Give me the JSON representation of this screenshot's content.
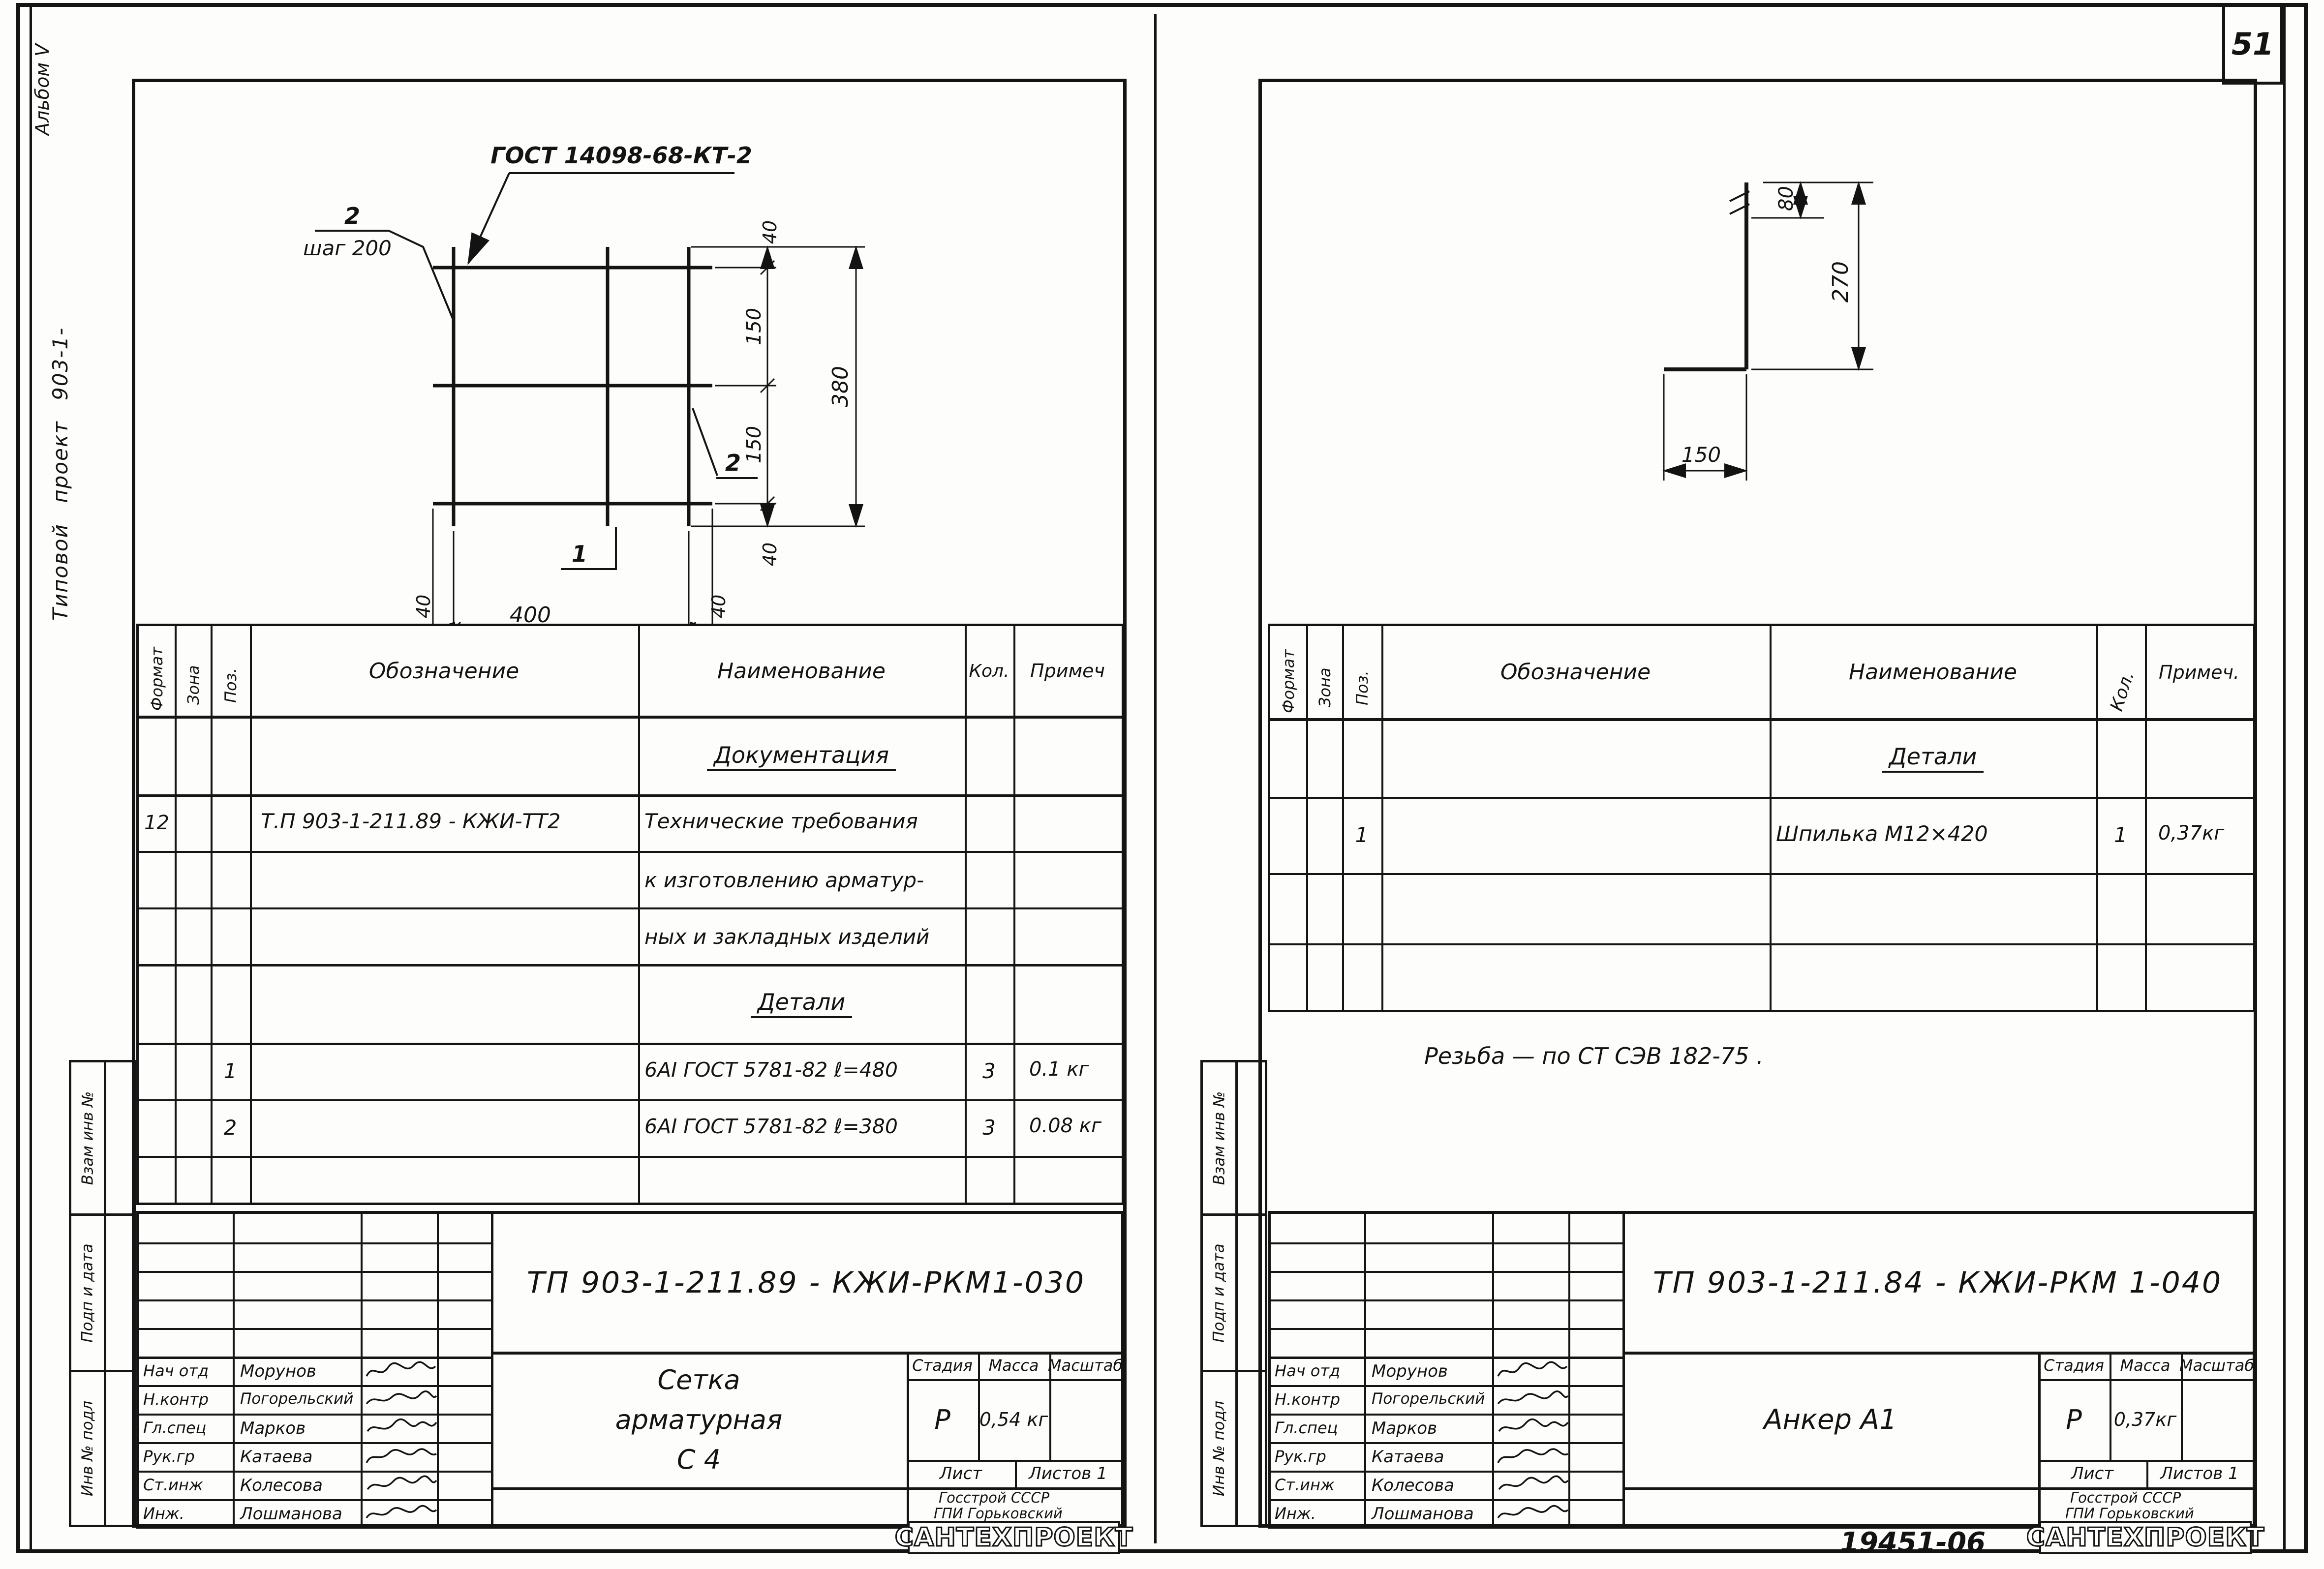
{
  "page": {
    "corner_number": "51",
    "footer_code": "19451-06",
    "footer_number": "52"
  },
  "margin": {
    "album": "Альбом V",
    "project": "Типовой   проект   903-1-",
    "stamps": {
      "replace": "Взам инв №",
      "sign": "Подп и дата",
      "inventory": "Инв № подл"
    }
  },
  "spec_headers": {
    "format": "Формат",
    "zone": "Зона",
    "pos": "Поз.",
    "designation": "Обозначение",
    "name": "Наименование",
    "qty": "Кол.",
    "note_l": "Примеч",
    "note_r": "Примеч."
  },
  "left": {
    "drawing": {
      "callout": "ГОСТ 14098-68-КТ-2",
      "mark_top": "2",
      "mark_top_sub": "шаг 200",
      "balloon_right": "2",
      "balloon_bottom": "1",
      "dim_40a": "40",
      "dim_150a": "150",
      "dim_150b": "150",
      "dim_40b": "40",
      "dim_380": "380",
      "dim_40c": "40",
      "dim_400": "400",
      "dim_40d": "40",
      "dim_480": "480"
    },
    "table": {
      "sec_doc": "Документация",
      "doc_format": "12",
      "doc_designation": "Т.П 903-1-211.89 - КЖИ-ТТ2",
      "doc_name1": "Технические требования",
      "doc_name2": "к изготовлению арматур-",
      "doc_name3": "ных и закладных изделий",
      "sec_det": "Детали",
      "rows": [
        {
          "pos": "1",
          "name": "6АI ГОСТ 5781-82  ℓ=480",
          "qty": "3",
          "note": "0.1 кг"
        },
        {
          "pos": "2",
          "name": "6АI ГОСТ 5781-82  ℓ=380",
          "qty": "3",
          "note": "0.08 кг"
        }
      ]
    },
    "tb": {
      "doc_number": "ТП 903-1-211.89 - КЖИ-РКМ1-030",
      "title1": "Сетка",
      "title2": "арматурная",
      "title3": "С 4",
      "stage": "Р",
      "mass": "0,54 кг",
      "scale": ""
    }
  },
  "right": {
    "drawing": {
      "dim_80": "80",
      "dim_270": "270",
      "dim_150": "150"
    },
    "table": {
      "sec_det": "Детали",
      "rows": [
        {
          "pos": "1",
          "name": "Шпилька   М12×420",
          "qty": "1",
          "note": "0,37кг"
        }
      ]
    },
    "note": "Резьба — по   СТ  СЭВ 182-75 .",
    "tb": {
      "doc_number": "ТП 903-1-211.84 - КЖИ-РКМ 1-040",
      "title1": "Анкер  А1",
      "stage": "Р",
      "mass": "0,37кг",
      "scale": ""
    }
  },
  "tb_labels": {
    "stage": "Стадия",
    "mass": "Масса",
    "scale": "Масштаб",
    "sheet": "Лист",
    "sheets": "Листов 1",
    "org1": "Госстрой СССР",
    "org2": "ГПИ  Горьковский",
    "org3": "САНТЕХПРОЕКТ"
  },
  "signers": [
    {
      "role": "Нач отд",
      "name": "Морунов"
    },
    {
      "role": "Н.контр",
      "name": "Погорельский"
    },
    {
      "role": "Гл.спец",
      "name": "Марков"
    },
    {
      "role": "Рук.гр",
      "name": "Катаева"
    },
    {
      "role": "Ст.инж",
      "name": "Колесова"
    },
    {
      "role": "Инж.",
      "name": "Лошманова"
    }
  ]
}
